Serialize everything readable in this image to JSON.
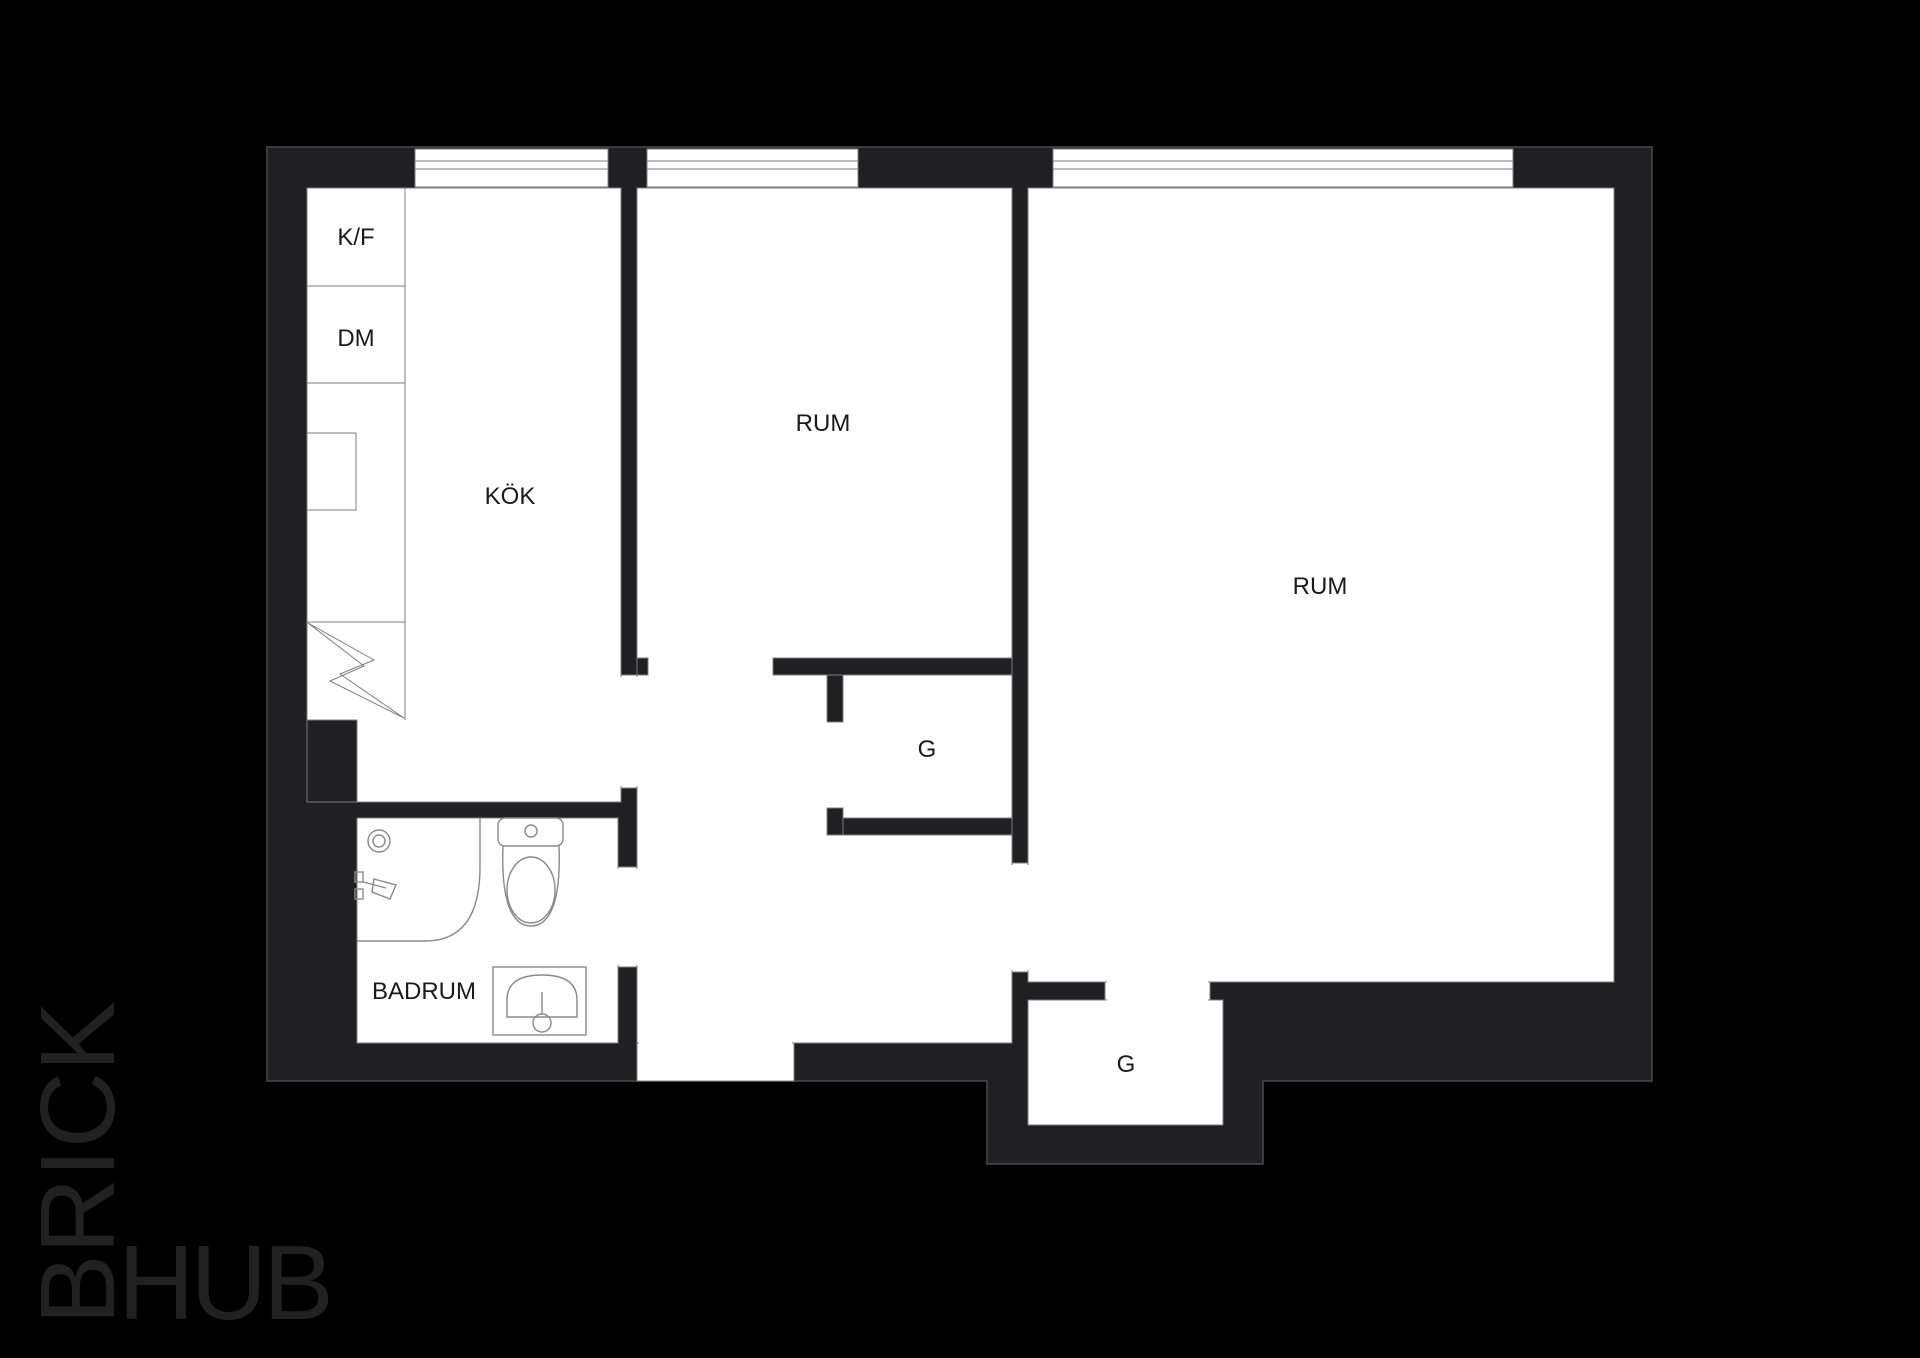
{
  "plan": {
    "labels": {
      "fridge_freezer": "K/F",
      "dishwasher": "DM",
      "kitchen": "KÖK",
      "room_middle": "RUM",
      "room_large": "RUM",
      "closet_middle": "G",
      "closet_bottom": "G",
      "bathroom": "BADRUM"
    }
  },
  "logo": {
    "brick": "BRICK",
    "hub": "HUB"
  },
  "colors": {
    "background": "#000000",
    "plan_body": "#202022",
    "plan_edge": "#4a4a4a",
    "outline": "#7d7d7d",
    "fixture": "#8a8a8a",
    "room_fill": "#ffffff",
    "label_text": "#1a1a1a",
    "logo_text": "#212121"
  }
}
